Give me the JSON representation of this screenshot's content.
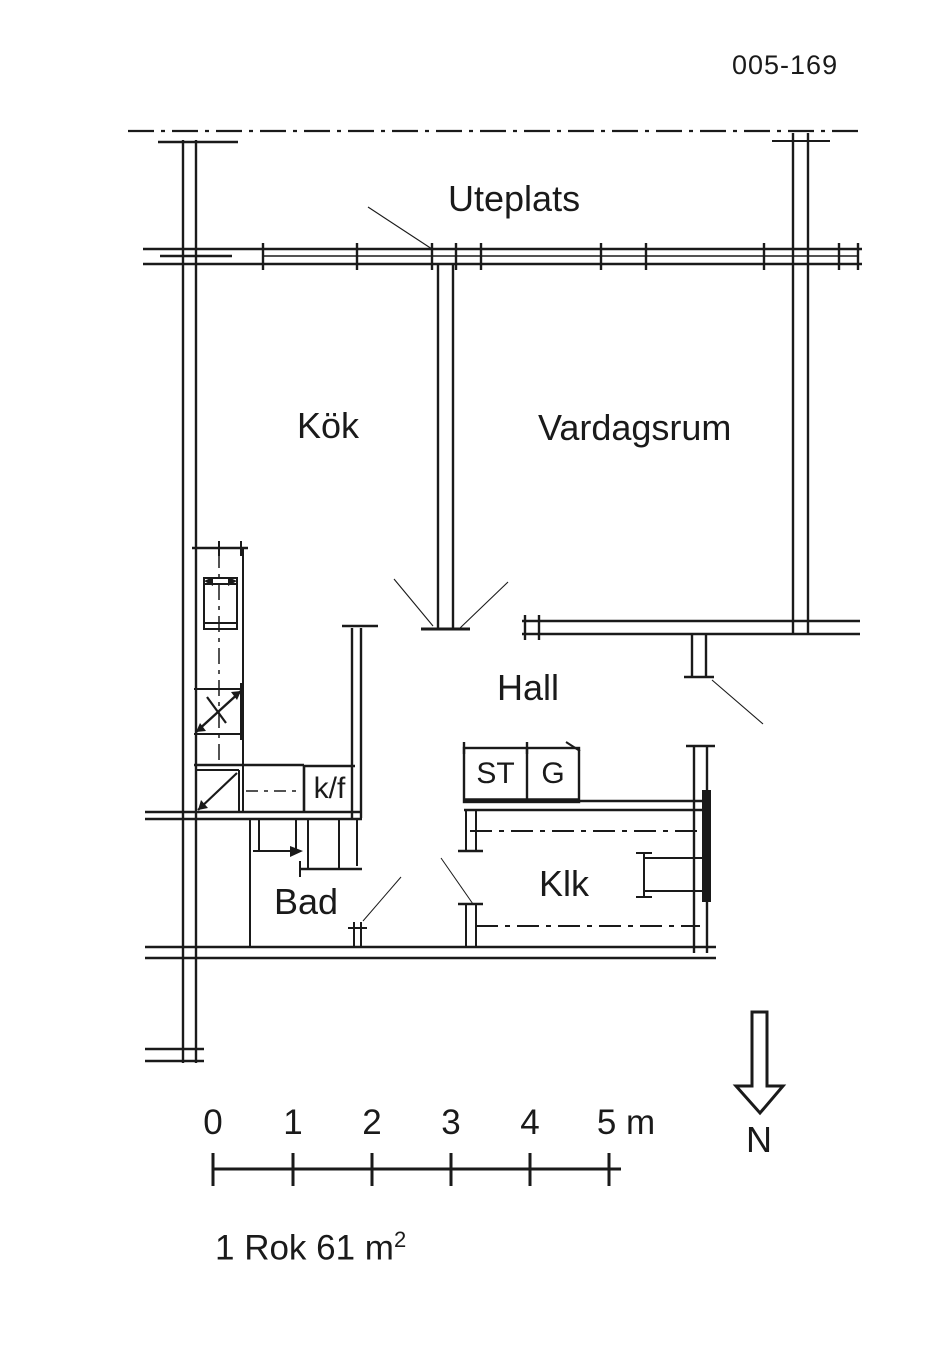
{
  "drawing": {
    "number": "005-169",
    "caption_prefix": "1 Rok 61 m",
    "caption_sup": "2"
  },
  "rooms": {
    "uteplats": "Uteplats",
    "kitchen": "Kök",
    "living_room": "Vardagsrum",
    "hall": "Hall",
    "bathroom": "Bad",
    "closet": "Klk",
    "fridge_freezer": "k/f",
    "cleaning_cabinet": "ST",
    "wardrobe": "G"
  },
  "scale_bar": {
    "labels": [
      "0",
      "1",
      "2",
      "3",
      "4",
      "5 m"
    ]
  },
  "compass": {
    "north_label": "N"
  },
  "colors": {
    "line": "#1a1a1a",
    "paper": "#ffffff"
  }
}
